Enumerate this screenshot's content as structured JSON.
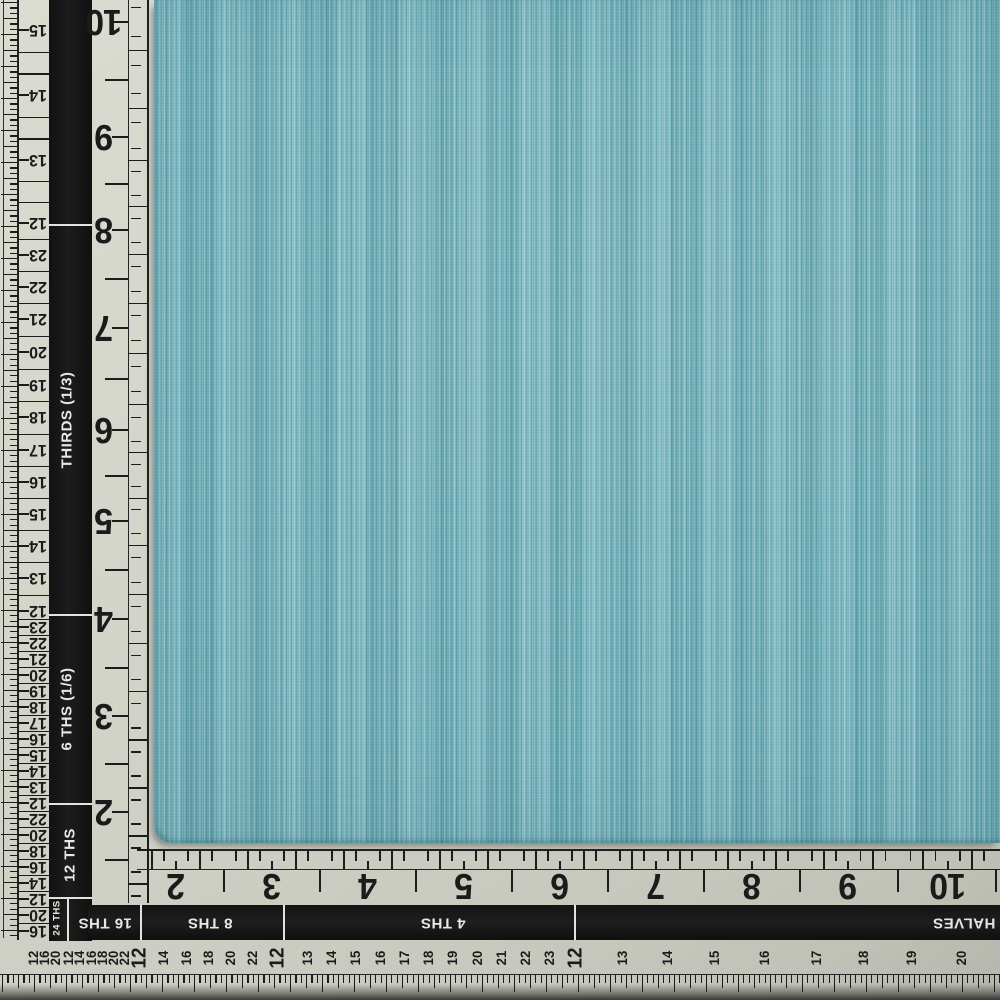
{
  "photo": {
    "subject": "solid teal chambray fabric swatch photographed on an L-shaped measuring ruler",
    "colors": {
      "fabric_base": "#75b3bd",
      "ruler_surface": "#d2d4c9",
      "band_black": "#161616",
      "ink": "#1c1c1c",
      "band_text": "#e8e8e4"
    }
  },
  "left_ruler": {
    "large_numbers": [
      {
        "v": "10",
        "y": 22
      },
      {
        "v": "9",
        "y": 137
      },
      {
        "v": "8",
        "y": 230
      },
      {
        "v": "7",
        "y": 328
      },
      {
        "v": "6",
        "y": 430
      },
      {
        "v": "5",
        "y": 521
      },
      {
        "v": "4",
        "y": 619
      },
      {
        "v": "3",
        "y": 716
      },
      {
        "v": "2",
        "y": 812
      }
    ],
    "ladder_numbers": [
      {
        "v": "15",
        "y": 30
      },
      {
        "v": "14",
        "y": 95
      },
      {
        "v": "13",
        "y": 160
      },
      {
        "v": "12",
        "y": 223
      },
      {
        "v": "23",
        "y": 255
      },
      {
        "v": "22",
        "y": 287
      },
      {
        "v": "21",
        "y": 319
      },
      {
        "v": "20",
        "y": 352
      },
      {
        "v": "19",
        "y": 385
      },
      {
        "v": "18",
        "y": 417
      },
      {
        "v": "17",
        "y": 450
      },
      {
        "v": "16",
        "y": 482
      },
      {
        "v": "15",
        "y": 514
      },
      {
        "v": "14",
        "y": 546
      },
      {
        "v": "13",
        "y": 578
      },
      {
        "v": "12",
        "y": 611
      },
      {
        "v": "23",
        "y": 627
      },
      {
        "v": "22",
        "y": 643
      },
      {
        "v": "21",
        "y": 659
      },
      {
        "v": "20",
        "y": 675
      },
      {
        "v": "19",
        "y": 691
      },
      {
        "v": "18",
        "y": 707
      },
      {
        "v": "17",
        "y": 723
      },
      {
        "v": "16",
        "y": 739
      },
      {
        "v": "15",
        "y": 755
      },
      {
        "v": "14",
        "y": 771
      },
      {
        "v": "13",
        "y": 787
      },
      {
        "v": "12",
        "y": 803
      },
      {
        "v": "22",
        "y": 819
      },
      {
        "v": "20",
        "y": 835
      },
      {
        "v": "18",
        "y": 851
      },
      {
        "v": "16",
        "y": 867
      },
      {
        "v": "14",
        "y": 883
      },
      {
        "v": "12",
        "y": 899
      },
      {
        "v": "20",
        "y": 915
      },
      {
        "v": "16",
        "y": 931
      }
    ],
    "band_labels": [
      {
        "text": "THIRDS (1/3)",
        "y": 420,
        "x": 67,
        "size": 15
      },
      {
        "text": "6 THS (1/6)",
        "y": 709,
        "x": 67,
        "size": 15
      },
      {
        "text": "12 THS",
        "y": 855,
        "x": 70,
        "size": 15
      },
      {
        "text": "24 THS",
        "y": 918,
        "x": 57,
        "size": 9.5
      }
    ],
    "separators_y": [
      224,
      614,
      803,
      897
    ]
  },
  "bottom_ruler": {
    "large_numbers": [
      {
        "v": "2",
        "x": 176
      },
      {
        "v": "3",
        "x": 272
      },
      {
        "v": "4",
        "x": 368
      },
      {
        "v": "5",
        "x": 464
      },
      {
        "v": "6",
        "x": 560
      },
      {
        "v": "7",
        "x": 656
      },
      {
        "v": "8",
        "x": 752
      },
      {
        "v": "9",
        "x": 848
      },
      {
        "v": "10",
        "x": 948
      }
    ],
    "small_numbers": [
      {
        "v": "12",
        "x": 33
      },
      {
        "v": "16",
        "x": 44
      },
      {
        "v": "20",
        "x": 55
      },
      {
        "v": "12",
        "x": 68
      },
      {
        "v": "14",
        "x": 79
      },
      {
        "v": "16",
        "x": 91
      },
      {
        "v": "18",
        "x": 102
      },
      {
        "v": "20",
        "x": 113
      },
      {
        "v": "22",
        "x": 124
      },
      {
        "v": "12",
        "x": 140,
        "big": true
      },
      {
        "v": "14",
        "x": 163
      },
      {
        "v": "16",
        "x": 186
      },
      {
        "v": "18",
        "x": 208
      },
      {
        "v": "20",
        "x": 230
      },
      {
        "v": "22",
        "x": 252
      },
      {
        "v": "12",
        "x": 278,
        "big": true
      },
      {
        "v": "13",
        "x": 307
      },
      {
        "v": "14",
        "x": 331
      },
      {
        "v": "15",
        "x": 355
      },
      {
        "v": "16",
        "x": 380
      },
      {
        "v": "17",
        "x": 404
      },
      {
        "v": "18",
        "x": 428
      },
      {
        "v": "19",
        "x": 452
      },
      {
        "v": "20",
        "x": 477
      },
      {
        "v": "21",
        "x": 501
      },
      {
        "v": "22",
        "x": 525
      },
      {
        "v": "23",
        "x": 549
      },
      {
        "v": "12",
        "x": 576,
        "big": true
      },
      {
        "v": "13",
        "x": 622
      },
      {
        "v": "14",
        "x": 667
      },
      {
        "v": "15",
        "x": 714
      },
      {
        "v": "16",
        "x": 764
      },
      {
        "v": "17",
        "x": 816
      },
      {
        "v": "18",
        "x": 863
      },
      {
        "v": "19",
        "x": 911
      },
      {
        "v": "20",
        "x": 961
      }
    ],
    "band_labels": [
      {
        "text": "16 THS",
        "x": 105
      },
      {
        "text": "8 THS",
        "x": 210
      },
      {
        "text": "4 THS",
        "x": 443
      },
      {
        "text": "HALVES",
        "x": 964
      }
    ],
    "separators_x": [
      140,
      283,
      574
    ]
  }
}
